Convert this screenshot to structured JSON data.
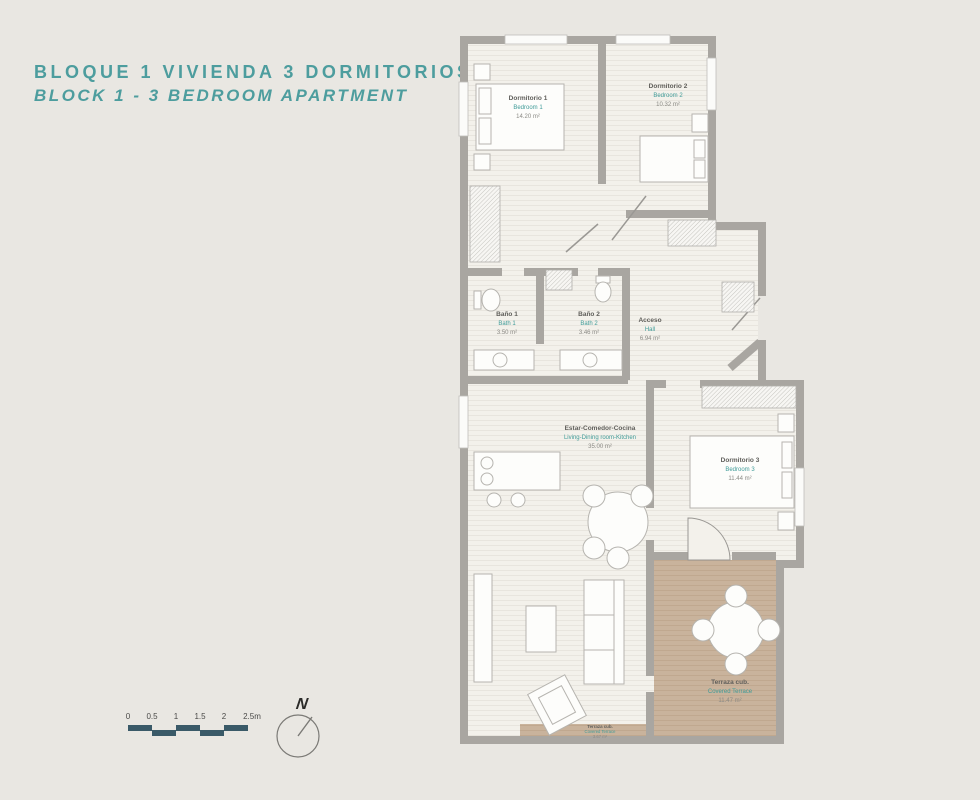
{
  "title": {
    "line1": "BLOQUE 1 VIVIENDA 3 DORMITORIOS",
    "line2": "BLOCK 1 - 3 BEDROOM APARTMENT"
  },
  "rooms": {
    "bedroom1": {
      "name_es": "Dormitorio 1",
      "name_en": "Bedroom 1",
      "area": "14.20 m²"
    },
    "bedroom2": {
      "name_es": "Dormitorio 2",
      "name_en": "Bedroom 2",
      "area": "10.32 m²"
    },
    "bath1": {
      "name_es": "Baño 1",
      "name_en": "Bath 1",
      "area": "3.50 m²"
    },
    "bath2": {
      "name_es": "Baño 2",
      "name_en": "Bath 2",
      "area": "3.46 m²"
    },
    "hall": {
      "name_es": "Acceso",
      "name_en": "Hall",
      "area": "6.94 m²"
    },
    "living": {
      "name_es": "Estar-Comedor-Cocina",
      "name_en": "Living-Dining room-Kitchen",
      "area": "35.00 m²"
    },
    "bedroom3": {
      "name_es": "Dormitorio 3",
      "name_en": "Bedroom 3",
      "area": "11.44 m²"
    },
    "terrace": {
      "name_es": "Terraza cub.",
      "name_en": "Covered Terrace",
      "area": "11.47 m²"
    },
    "terrace_strip": {
      "name_es": "Terraza cub.",
      "name_en": "Covered Terrace",
      "area": "3.67 m²"
    }
  },
  "scale_bar": {
    "labels": [
      "0",
      "0.5",
      "1",
      "1.5",
      "2",
      "2.5m"
    ]
  },
  "compass": {
    "north_label": "N"
  },
  "colors": {
    "background": "#e9e7e2",
    "accent_teal": "#4d9d9e",
    "label_teal": "#3f9b98",
    "wall_gray": "#a9a6a1",
    "floor": "#f3f1eb",
    "terrace_tan": "#c9b39c",
    "scale_bar": "#3a5a68"
  }
}
